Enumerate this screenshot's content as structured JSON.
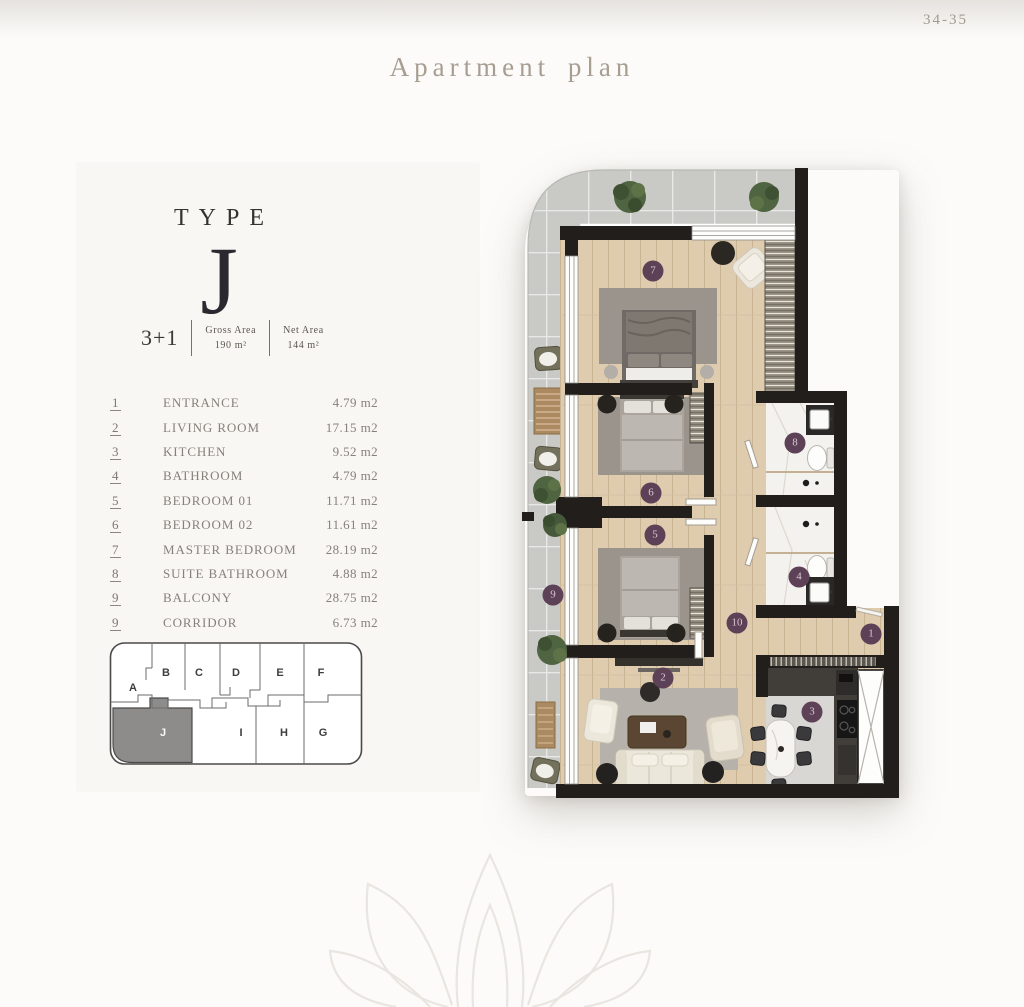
{
  "page": {
    "corner_pages": "34-35",
    "title": "Apartment plan"
  },
  "unit": {
    "type_label": "TYPE",
    "type_letter": "J",
    "layout": "3+1",
    "gross": {
      "label": "Gross Area",
      "value": "190 m²"
    },
    "net": {
      "label": "Net Area",
      "value": "144 m²"
    }
  },
  "room_list": [
    {
      "no": "1",
      "name": "ENTRANCE",
      "area": "4.79 m2"
    },
    {
      "no": "2",
      "name": "LIVING ROOM",
      "area": "17.15 m2"
    },
    {
      "no": "3",
      "name": "KITCHEN",
      "area": "9.52 m2"
    },
    {
      "no": "4",
      "name": "BATHROOM",
      "area": "4.79 m2"
    },
    {
      "no": "5",
      "name": "BEDROOM 01",
      "area": "11.71 m2"
    },
    {
      "no": "6",
      "name": "BEDROOM 02",
      "area": "11.61 m2"
    },
    {
      "no": "7",
      "name": "MASTER BEDROOM",
      "area": "28.19 m2"
    },
    {
      "no": "8",
      "name": "SUITE BATHROOM",
      "area": "4.88 m2"
    },
    {
      "no": "9",
      "name": "BALCONY",
      "area": "28.75 m2"
    },
    {
      "no": "9",
      "name": "CORRIDOR",
      "area": "6.73 m2"
    }
  ],
  "key_plan": {
    "highlighted_unit": "J",
    "units": [
      {
        "letter": "A",
        "x": 25,
        "y": 48
      },
      {
        "letter": "B",
        "x": 58,
        "y": 33
      },
      {
        "letter": "C",
        "x": 91,
        "y": 33
      },
      {
        "letter": "D",
        "x": 128,
        "y": 33
      },
      {
        "letter": "E",
        "x": 172,
        "y": 33
      },
      {
        "letter": "F",
        "x": 213,
        "y": 33
      },
      {
        "letter": "J",
        "x": 55,
        "y": 93,
        "highlighted": true
      },
      {
        "letter": "I",
        "x": 133,
        "y": 93
      },
      {
        "letter": "H",
        "x": 176,
        "y": 93
      },
      {
        "letter": "G",
        "x": 215,
        "y": 93
      }
    ]
  },
  "floor_plan": {
    "room_markers": [
      {
        "n": "7",
        "x": 653,
        "y": 271
      },
      {
        "n": "6",
        "x": 651,
        "y": 493
      },
      {
        "n": "5",
        "x": 655,
        "y": 535
      },
      {
        "n": "8",
        "x": 795,
        "y": 443
      },
      {
        "n": "4",
        "x": 799,
        "y": 577
      },
      {
        "n": "9",
        "x": 553,
        "y": 595
      },
      {
        "n": "10",
        "x": 737,
        "y": 623
      },
      {
        "n": "1",
        "x": 871,
        "y": 634
      },
      {
        "n": "2",
        "x": 663,
        "y": 678
      },
      {
        "n": "3",
        "x": 812,
        "y": 712
      }
    ]
  },
  "colors": {
    "accent_text": "#a79d90",
    "marker": "#5d4156",
    "wall": "#221e1c",
    "wood_floor": "#dfccae",
    "balcony_tile": "#c9c9c6",
    "keyplan_highlight": "#8e8c8a"
  }
}
